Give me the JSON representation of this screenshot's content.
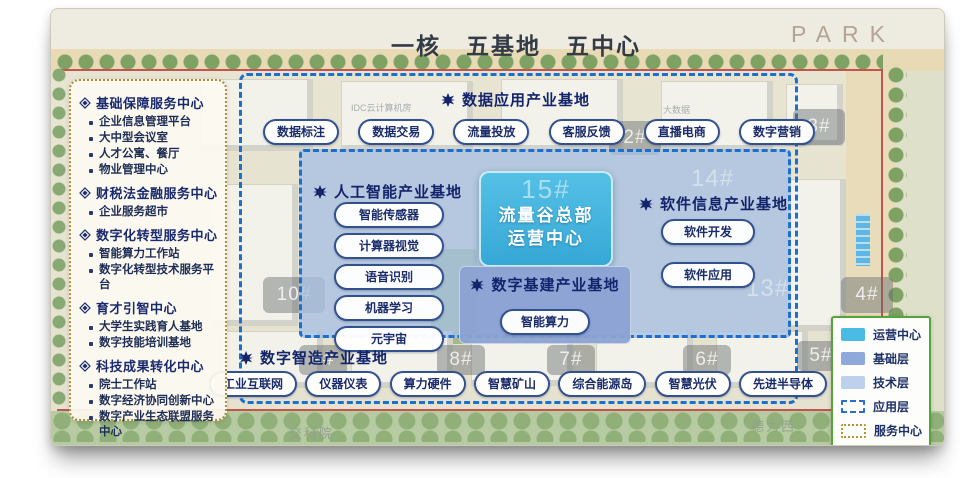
{
  "title": "一核　五基地　五中心",
  "brand": "PARK",
  "sidebar": {
    "sections": [
      {
        "title": "基础保障服务中心",
        "items": [
          "企业信息管理平台",
          "大中型会议室",
          "人才公寓、餐厅",
          "物业管理中心"
        ]
      },
      {
        "title": "财税法金融服务中心",
        "items": [
          "企业服务超市"
        ]
      },
      {
        "title": "数字化转型服务中心",
        "items": [
          "智能算力工作站",
          "数字化转型技术服务平台"
        ]
      },
      {
        "title": "育才引智中心",
        "items": [
          "大学生实践育人基地",
          "数字技能培训基地"
        ]
      },
      {
        "title": "科技成果转化中心",
        "items": [
          "院士工作站",
          "数字经济协同创新中心",
          "数字产业生态联盟服务中心"
        ]
      }
    ]
  },
  "bases": {
    "data_app": {
      "title": "数据应用产业基地",
      "buttons": [
        "数据标注",
        "数据交易",
        "流量投放",
        "客服反馈",
        "直播电商",
        "数字营销"
      ]
    },
    "ai": {
      "title": "人工智能产业基地",
      "buttons": [
        "智能传感器",
        "计算器视觉",
        "语音识别",
        "机器学习",
        "元宇宙"
      ]
    },
    "software": {
      "title": "软件信息产业基地",
      "buttons": [
        "软件开发",
        "软件应用"
      ]
    },
    "infra": {
      "title": "数字基建产业基地",
      "buttons": [
        "智能算力"
      ]
    },
    "manufacturing": {
      "title": "数字智造产业基地",
      "buttons": [
        "工业互联网",
        "仪器仪表",
        "算力硬件",
        "智慧矿山",
        "综合能源岛",
        "智慧光伏",
        "先进半导体"
      ]
    }
  },
  "core": {
    "watermark": "15#",
    "line1": "流量谷总部",
    "line2": "运营中心"
  },
  "buildings": {
    "b2": "2#",
    "b3": "3#",
    "b4": "4#",
    "b5": "5#",
    "b6": "6#",
    "b7": "7#",
    "b8": "8#",
    "b9": "9#",
    "b10": "10#",
    "b12": "12#",
    "b13": "13#",
    "b14": "14#"
  },
  "map_texts": {
    "idc": "IDC云计算机房",
    "bigdata": "大数据",
    "jiaokeyuan": "交科院",
    "delixi": "德力西"
  },
  "legend": {
    "items": [
      {
        "label": "运营中心",
        "swatch": "#49bbe4"
      },
      {
        "label": "基础层",
        "swatch": "#8fa8db"
      },
      {
        "label": "技术层",
        "swatch": "#bdd0ec"
      },
      {
        "label": "应用层",
        "swatch": "dashed-blue"
      },
      {
        "label": "服务中心",
        "swatch": "dotted-gold"
      }
    ]
  },
  "colors": {
    "accent_navy": "#13246b",
    "dash_blue": "#1d6ecd",
    "operation_cyan": "#49bbe4",
    "base_blue": "#8fa8db",
    "tech_blue": "#bdd0ec",
    "legend_green": "#57a33b",
    "service_gold": "#ab8d3c",
    "boundary_red": "#c4554e"
  }
}
